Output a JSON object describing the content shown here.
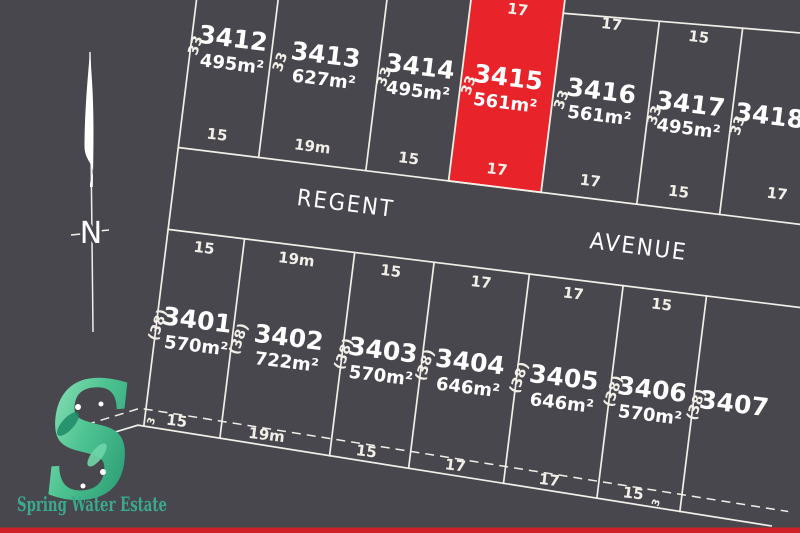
{
  "colors": {
    "background": "#47474d",
    "line": "#f2efe9",
    "highlight": "#e8232a",
    "bottom_bar": "#cf2027",
    "logo_green": "#3aa98c"
  },
  "street": {
    "word1": "REGENT",
    "word2": "AVENUE"
  },
  "compass": {
    "label": "N"
  },
  "logo": {
    "letter": "S",
    "wordmark": "Spring Water Estate"
  },
  "lots": {
    "l3412": {
      "number": "3412",
      "area": "495m²",
      "depth": "33",
      "front": "15"
    },
    "l3413": {
      "number": "3413",
      "area": "627m²",
      "depth": "33",
      "front": "19m"
    },
    "l3414": {
      "number": "3414",
      "area": "495m²",
      "depth": "33",
      "front": "15"
    },
    "l3415": {
      "number": "3415",
      "area": "561m²",
      "depth": "33",
      "front": "17",
      "rear": "17",
      "highlighted": true
    },
    "l3416": {
      "number": "3416",
      "area": "561m²",
      "depth": "33",
      "front": "17",
      "rear": "17"
    },
    "l3417": {
      "number": "3417",
      "area": "495m²",
      "depth": "33",
      "front": "15",
      "rear": "15"
    },
    "l3418": {
      "number": "3418",
      "depth": "33",
      "front": "17"
    },
    "l3401": {
      "number": "3401",
      "area": "570m²",
      "depth": "(38)",
      "front": "15",
      "rear": "15",
      "rear_offset": "3"
    },
    "l3402": {
      "number": "3402",
      "area": "722m²",
      "depth": "(38)",
      "front": "19m",
      "rear": "19m"
    },
    "l3403": {
      "number": "3403",
      "area": "570m²",
      "depth": "(38)",
      "front": "15",
      "rear": "15"
    },
    "l3404": {
      "number": "3404",
      "area": "646m²",
      "depth": "(38)",
      "front": "17",
      "rear": "17"
    },
    "l3405": {
      "number": "3405",
      "area": "646m²",
      "depth": "(38)",
      "front": "17",
      "rear": "17"
    },
    "l3406": {
      "number": "3406",
      "area": "570m²",
      "depth": "(38)",
      "front": "15",
      "rear": "15",
      "rear_offset": "3"
    },
    "l3407": {
      "number": "3407",
      "depth": "(38)"
    }
  }
}
